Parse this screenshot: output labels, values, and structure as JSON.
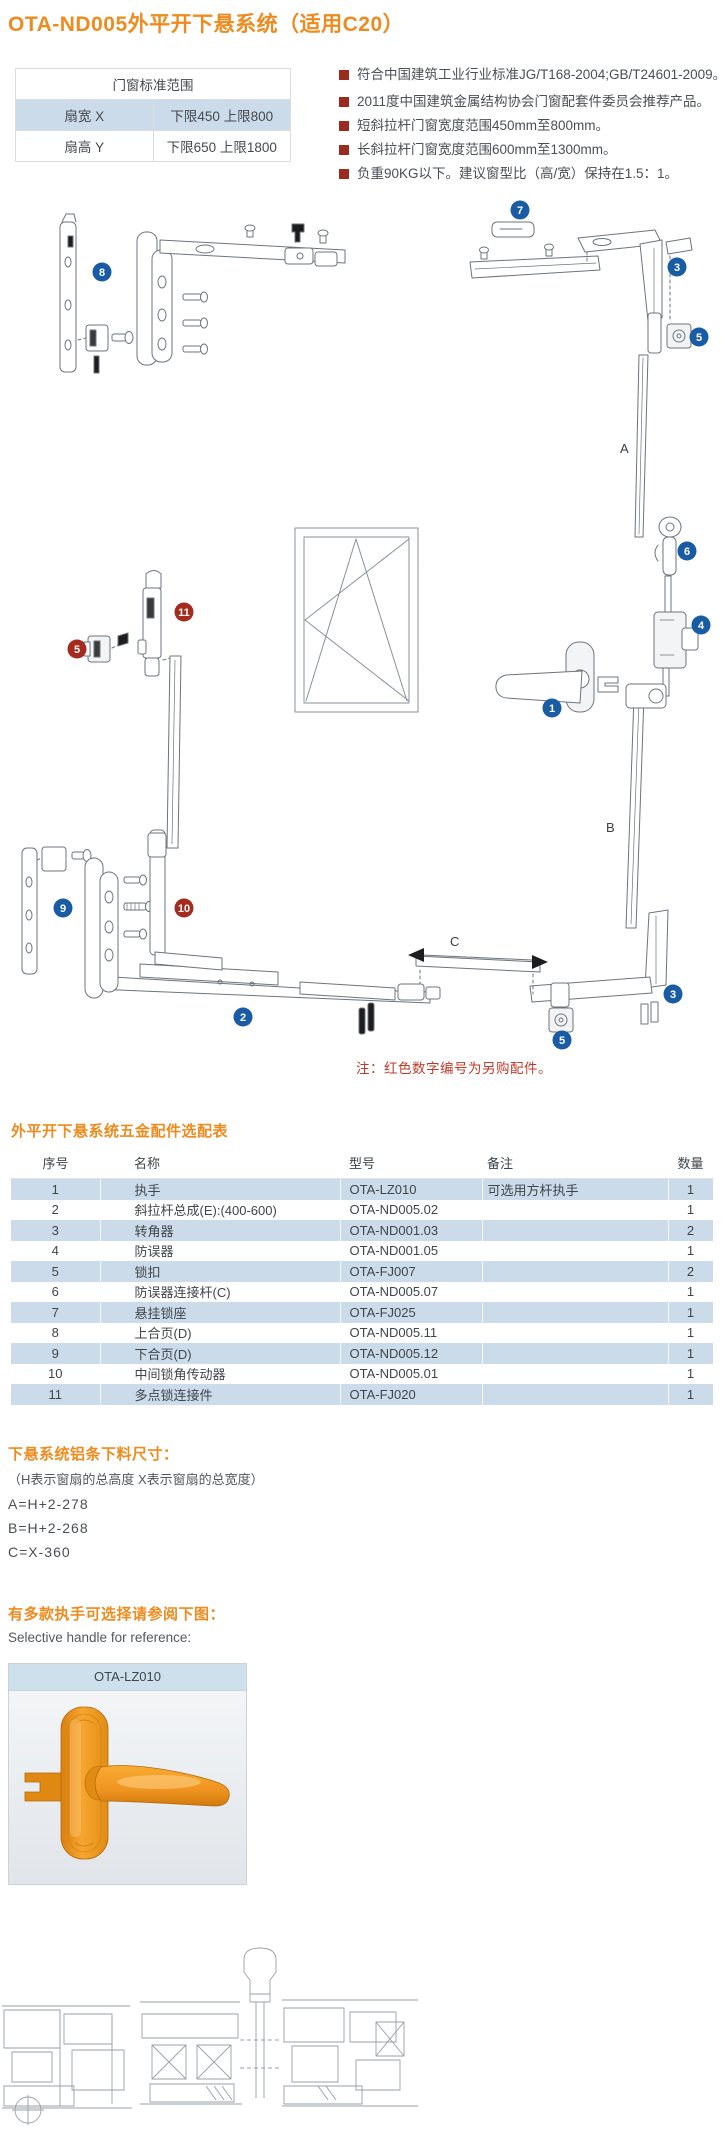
{
  "page": {
    "title": "OTA-ND005外平开下悬系统（适用C20）"
  },
  "standards_table": {
    "title": "门窗标准范围",
    "rows": [
      {
        "label": "扇宽 X",
        "value": "下限450 上限800"
      },
      {
        "label": "扇高 Y",
        "value": "下限650 上限1800"
      }
    ]
  },
  "features": [
    "符合中国建筑工业行业标准JG/T168-2004;GB/T24601-2009。",
    "2011度中国建筑金属结构协会门窗配套件委员会推荐产品。",
    "短斜拉杆门窗宽度范围450mm至800mm。",
    "长斜拉杆门窗宽度范围600mm至1300mm。",
    "负重90KG以下。建议窗型比（高/宽）保持在1.5：1。"
  ],
  "diagram": {
    "note": "注：红色数字编号为另购配件。",
    "dim_a": "A",
    "dim_b": "B",
    "dim_c": "C",
    "badges": {
      "b8": "8",
      "b7": "7",
      "b3_top": "3",
      "b5_top": "5",
      "b6": "6",
      "b4": "4",
      "b1": "1",
      "b9": "9",
      "b2": "2",
      "b3_bottom": "3",
      "b5_bottom": "5",
      "r11": "11",
      "r5": "5",
      "r10": "10"
    }
  },
  "parts_table": {
    "title": "外平开下悬系统五金配件选配表",
    "headers": [
      "序号",
      "名称",
      "型号",
      "备注",
      "数量"
    ],
    "rows": [
      [
        "1",
        "执手",
        "OTA-LZ010",
        "可选用方杆执手",
        "1"
      ],
      [
        "2",
        "斜拉杆总成(E):(400-600)",
        "OTA-ND005.02",
        "",
        "1"
      ],
      [
        "3",
        "转角器",
        "OTA-ND001.03",
        "",
        "2"
      ],
      [
        "4",
        "防误器",
        "OTA-ND001.05",
        "",
        "1"
      ],
      [
        "5",
        "锁扣",
        "OTA-FJ007",
        "",
        "2"
      ],
      [
        "6",
        "防误器连接杆(C)",
        "OTA-ND005.07",
        "",
        "1"
      ],
      [
        "7",
        "悬挂锁座",
        "OTA-FJ025",
        "",
        "1"
      ],
      [
        "8",
        "上合页(D)",
        "OTA-ND005.11",
        "",
        "1"
      ],
      [
        "9",
        "下合页(D)",
        "OTA-ND005.12",
        "",
        "1"
      ],
      [
        "10",
        "中间锁角传动器",
        "OTA-ND005.01",
        "",
        "1"
      ],
      [
        "11",
        "多点锁连接件",
        "OTA-FJ020",
        "",
        "1"
      ]
    ]
  },
  "cutting_size": {
    "title": "下悬系统铝条下料尺寸：",
    "subtitle": "（H表示窗扇的总高度  X表示窗扇的总宽度）",
    "formula_a": "A=H+2-278",
    "formula_b": "B=H+2-268",
    "formula_c": "C=X-360"
  },
  "handle_section": {
    "title_zh": "有多款执手可选择请参阅下图：",
    "title_en": "Selective handle for reference:",
    "model": "OTA-LZ010"
  },
  "colors": {
    "accent_orange": "#ee8b1e",
    "badge_blue": "#1a5ca3",
    "badge_red": "#a42b1d",
    "bullet_red": "#9c2b1f",
    "table_blue": "#ccdbe9",
    "note_red": "#c03a2a"
  }
}
